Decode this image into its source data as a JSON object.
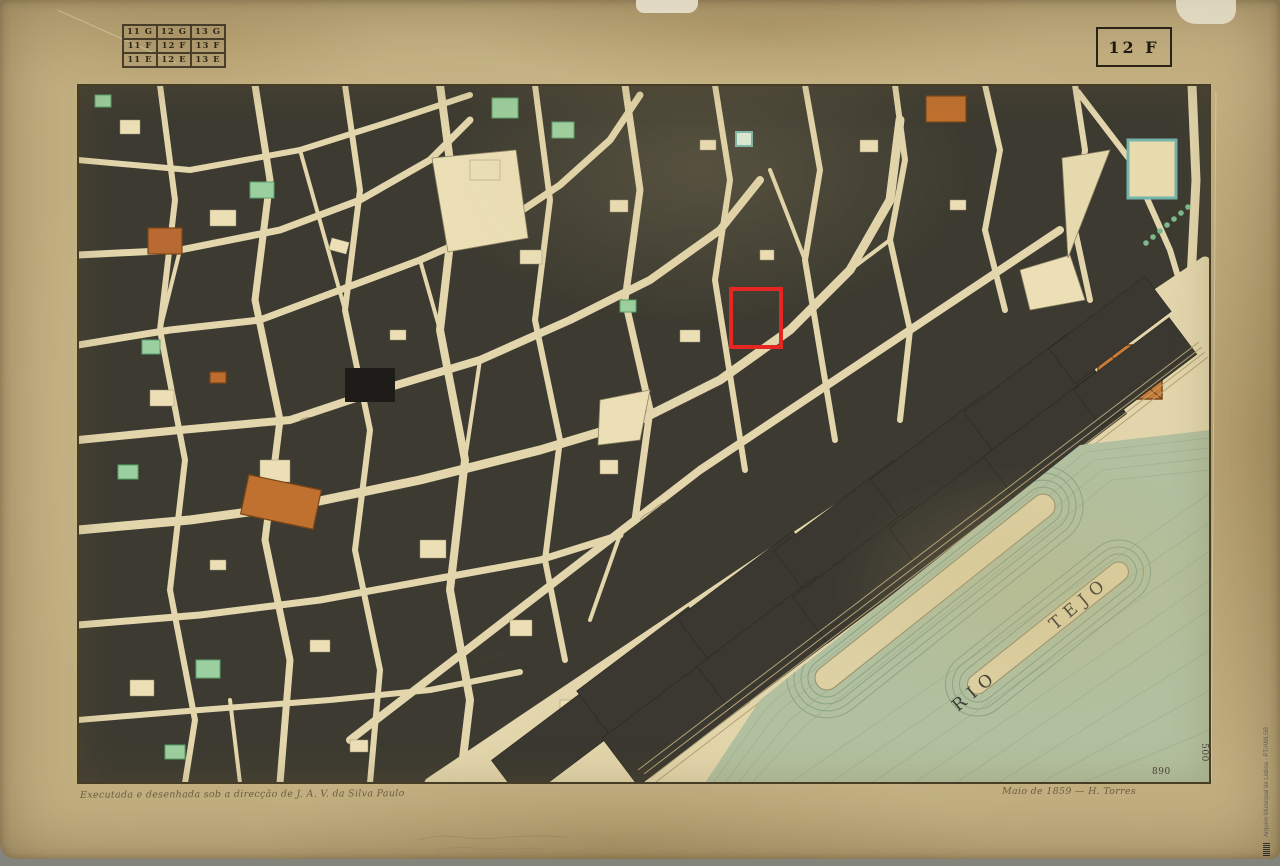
{
  "header": {
    "index_grid": {
      "rows": [
        [
          "11 G",
          "12 G",
          "13 G"
        ],
        [
          "11 F",
          "12 F",
          "13 F"
        ],
        [
          "11 E",
          "12 E",
          "13 E"
        ]
      ],
      "current_sheet": "12 F"
    },
    "sheet_label": "12 F"
  },
  "frame_numbers": {
    "top_left_h": "0",
    "top_left_v": "0",
    "top_right_h": "890",
    "top_right_v": "0",
    "bottom_left_h": "0",
    "bottom_left_v": "500",
    "bottom_right_h": "890",
    "bottom_right_v": "500"
  },
  "map": {
    "river_label": "RIO TEJO"
  },
  "inscriptions": {
    "credit_left": "Executada e desenhada sob a direcção de J. A. V. da Silva Paulo",
    "credit_right": "Maio de 1859 — H. Torres"
  },
  "watermark": {
    "archive_text": "Arquivo Municipal de Lisboa · PT/AMLSB"
  },
  "annotation": {
    "highlight_color": "#e62621"
  },
  "colors": {
    "paper": "#c3b081",
    "ink": "#3c3429",
    "city_block": "#3d3b31",
    "street": "#e3d6ac",
    "water": "#b2c09f",
    "accent_red": "#e62621"
  }
}
